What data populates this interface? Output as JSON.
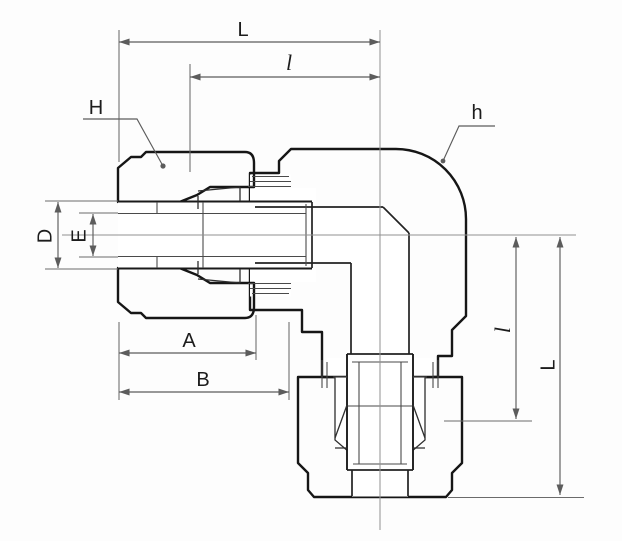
{
  "drawing": {
    "colors": {
      "section_fill": "#d6d6d6",
      "pocket_fill": "#ffffff",
      "outline": "#161616",
      "dimension": "#5c5c5c",
      "centerline": "#919191",
      "background": "#fdfdfd"
    },
    "labels": {
      "top_length": "L",
      "top_insertion": "l",
      "nut_callout": "H",
      "body_callout": "h",
      "tube_od": "D",
      "bore_dia": "E",
      "nut_width": "A",
      "assembly_width": "B",
      "side_insertion": "l",
      "side_length": "L"
    }
  }
}
